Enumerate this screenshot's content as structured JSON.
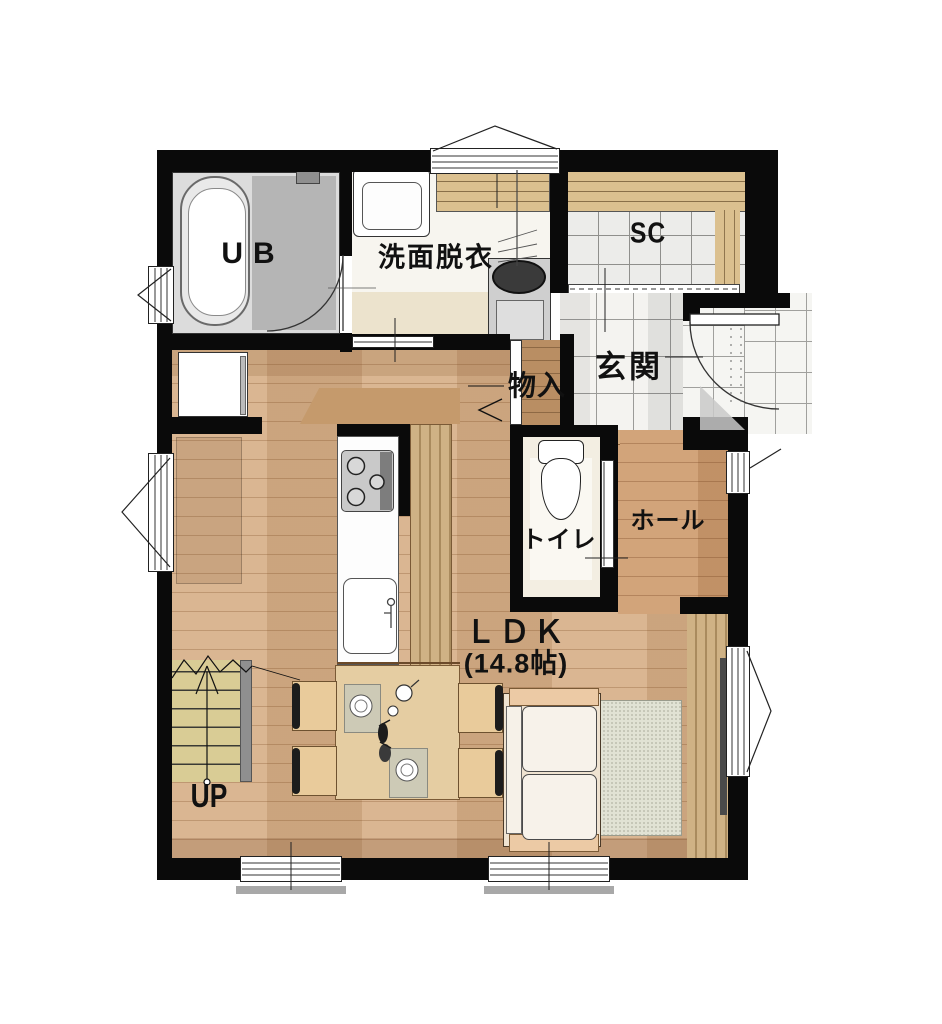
{
  "plan": {
    "type": "floor-plan-first-floor",
    "rooms": [
      {
        "id": "ub",
        "label": "UB"
      },
      {
        "id": "washroom",
        "label": "洗面脱衣"
      },
      {
        "id": "shoe_closet",
        "label": "SC"
      },
      {
        "id": "entrance",
        "label": "玄関"
      },
      {
        "id": "storage",
        "label": "物入"
      },
      {
        "id": "toilet",
        "label": "トイレ"
      },
      {
        "id": "hall",
        "label": "ホール"
      },
      {
        "id": "ldk",
        "label": "ＬＤＫ",
        "size": "(14.8帖)"
      },
      {
        "id": "stairs",
        "label": "UP"
      }
    ],
    "furniture": [
      "bathtub",
      "washbasin",
      "washing-machine",
      "refrigerator",
      "kitchen-island",
      "gas-stove",
      "kitchen-sink",
      "bar-counter",
      "dining-table",
      "chairs",
      "placemats",
      "sofa",
      "rug",
      "toilet-fixture",
      "staircase",
      "entry-door",
      "wood-slat-panel"
    ],
    "colors": {
      "wall": "#0a0a0a",
      "ldk_floor": "#d7b18a",
      "hall_floor": "#cf9e72",
      "entrance_tile": "#f4f3f0",
      "bath_tile": "#cfcfcf",
      "stair_tread": "#d9cc95",
      "counter_wood": "#cdb184",
      "rug": "#e1e2d4"
    }
  }
}
